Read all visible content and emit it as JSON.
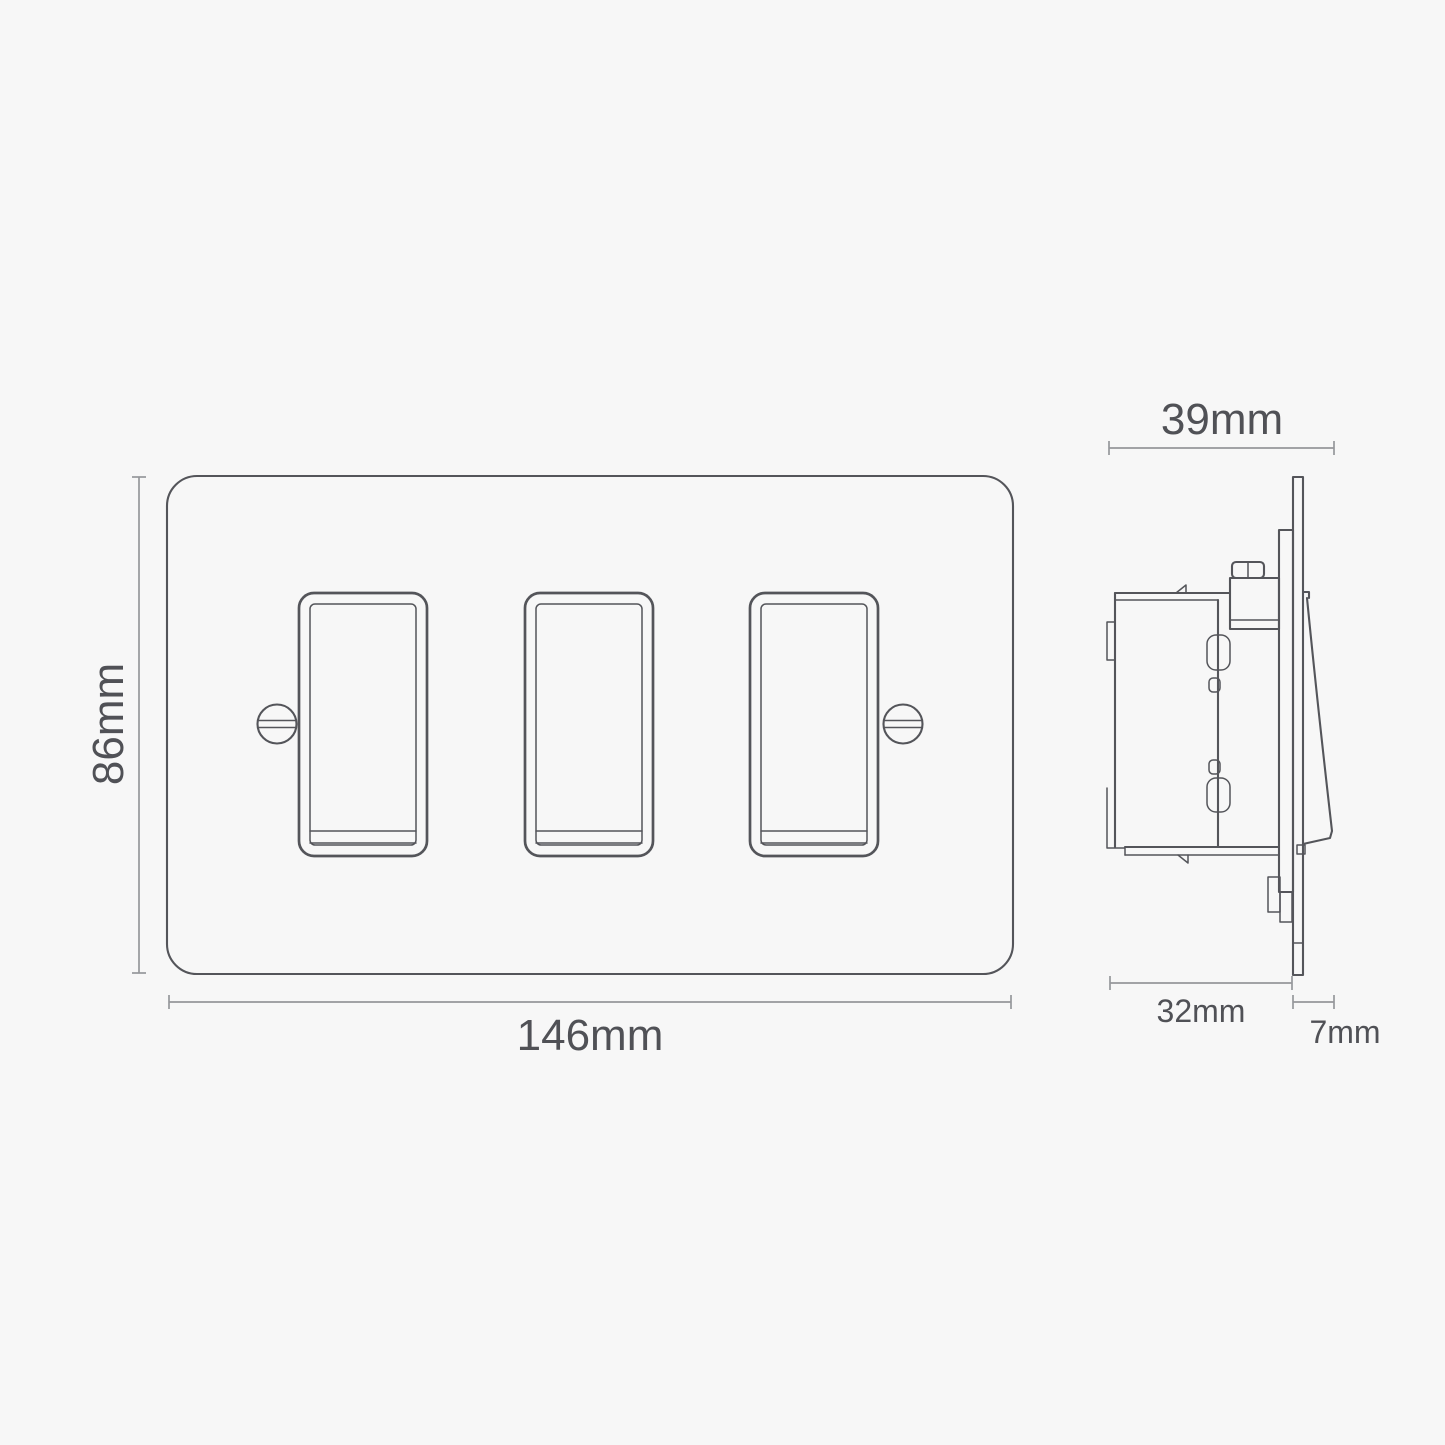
{
  "diagram": {
    "front_view": {
      "height_label": "86mm",
      "width_label": "146mm",
      "rocker_count": 3
    },
    "side_view": {
      "overall_depth_label": "39mm",
      "mounting_depth_label": "32mm",
      "faceplate_depth_label": "7mm"
    },
    "theme": {
      "background": "#f7f7f7",
      "outline_color": "#54555a",
      "dimension_line_color": "#96979b",
      "label_color": "#505156"
    }
  }
}
